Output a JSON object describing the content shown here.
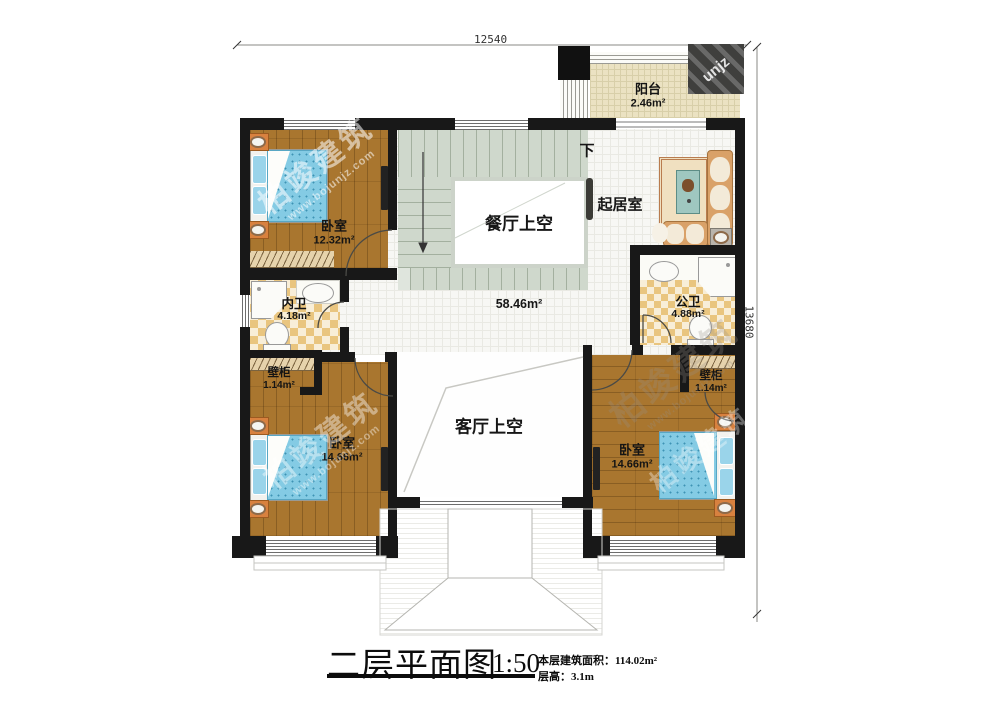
{
  "dimensions": {
    "top": "12540",
    "right": "13680"
  },
  "rooms": {
    "balcony": {
      "label": "阳台",
      "area": "2.46m²"
    },
    "bedroom_top_left": {
      "label": "卧室",
      "area": "12.32m²"
    },
    "inner_bathroom": {
      "label": "内卫",
      "area": "4.18m²"
    },
    "public_bathroom": {
      "label": "公卫",
      "area": "4.88m²"
    },
    "closet_left": {
      "label": "壁柜",
      "area": "1.14m²"
    },
    "closet_right": {
      "label": "壁柜",
      "area": "1.14m²"
    },
    "bedroom_bottom_left": {
      "label": "卧室",
      "area": "14.66m²"
    },
    "bedroom_bottom_right": {
      "label": "卧室",
      "area": "14.66m²"
    },
    "sitting_room": {
      "label": "起居室"
    },
    "dining_void": {
      "label": "餐厅上空"
    },
    "living_void": {
      "label": "客厅上空"
    }
  },
  "annotations": {
    "open_area": "58.46m²",
    "stairs_down": "下"
  },
  "title_block": {
    "title": "二层平面图",
    "scale": "1:50",
    "area_label": "本层建筑面积：",
    "area_value": "114.02m²",
    "height_label": "层高：",
    "height_value": "3.1m"
  },
  "watermark": {
    "brand": "柏竣建筑",
    "site": "www.bojunjz.com",
    "logo_text": "unjz"
  },
  "colors": {
    "wall": "#181818",
    "wood_floor": "#a9762f",
    "bed": "#84cbe4",
    "tile_checker": "#e9c57f",
    "stairs": "#cfd8cc",
    "balcony_floor": "#ebe2c2",
    "sofa": "#d9a168",
    "void_border": "#ccd3c9"
  }
}
